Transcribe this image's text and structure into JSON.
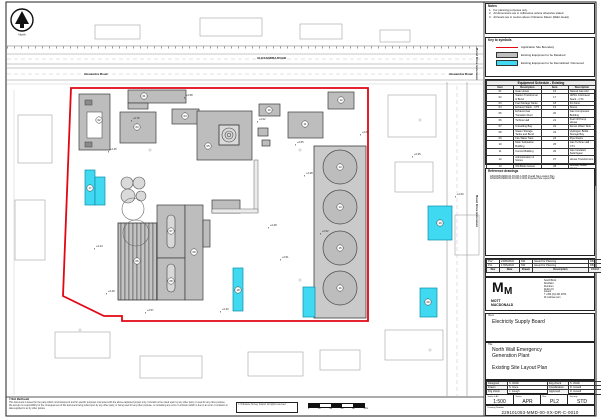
{
  "sheet": {
    "north_label": "North",
    "scalebar_ticks": [
      "0",
      "10",
      "20",
      "30",
      "40",
      "50m"
    ]
  },
  "notes": {
    "title": "Notes",
    "items": [
      "For planning purposes only.",
      "All dimensions are in millimetres unless otherwise stated.",
      "All levels are in metres above Ordnance Datum (Malin Head)."
    ]
  },
  "key": {
    "title": "Key to symbols",
    "items": [
      {
        "swatch": "red-line",
        "label": "Application Site Boundary"
      },
      {
        "swatch": "grey-fill",
        "label": "Existing Equipment to be Retained"
      },
      {
        "swatch": "cyan-fill",
        "label": "Existing Equipment to be Demolished / Removed"
      }
    ]
  },
  "equipment_schedule": {
    "title": "Equipment Schedule - Existing",
    "columns": [
      "Item",
      "Description",
      "Item",
      "Description"
    ],
    "rows": [
      [
        "01",
        "Gate House",
        "16",
        "Natural Gas AGI"
      ],
      [
        "02",
        "Station Transformer & Bund",
        "17",
        "HRSG & Exhaust Stack - CT4"
      ],
      [
        "03",
        "Fuel Storage Tanks",
        "18",
        "Fin Fans"
      ],
      [
        "04",
        "Exhaust Stack - CT5",
        "19",
        "Stores"
      ],
      [
        "05",
        "Exhaust Gas Transition Duct",
        "20",
        "Gas Compressor Building"
      ],
      [
        "06",
        "Turbine Hall",
        "21",
        "Fuel Oil Pump House"
      ],
      [
        "07",
        "Unloading Bay",
        "22",
        "Demin Water Tank"
      ],
      [
        "08",
        "Steam Storage Tanks and Bund",
        "23",
        "Hydrogen Bottle Storage Bay"
      ],
      [
        "09",
        "Fire Water Tank",
        "24",
        "Pipe Racks"
      ],
      [
        "10",
        "Main Substation Building",
        "25",
        "Gas Turbine Hall - CT4"
      ],
      [
        "11",
        "Control Building",
        "26",
        "Gas Insulated Switchgear"
      ],
      [
        "12",
        "Administration & Stores",
        "27",
        "House Transformers"
      ],
      [
        "13",
        "Old Boiler House",
        "28",
        "Auxiliary Boiler House"
      ],
      [
        "14",
        "Water & Diesel Storage Tanks",
        "29",
        "CW Pump House"
      ],
      [
        "15",
        "Water Treatment Building",
        "30",
        "220kV Substation"
      ]
    ]
  },
  "reference_drawings": {
    "title": "Reference drawings",
    "items": [
      {
        "number": "229101053-MMD-00-XX-DR-C-0005",
        "title": "Overall Site Location Plan"
      },
      {
        "number": "229101053-MMD-00-XX-DR-C-0011",
        "title": "Proposed Site Layout Plan"
      }
    ]
  },
  "revisions": {
    "header": [
      "Rev",
      "Date",
      "Drawn",
      "Description",
      "Ch'k'd",
      "App'd"
    ],
    "rows": [
      [
        "PL2",
        "24/06/2022",
        "SW",
        "Issued for Planning",
        "RB",
        "DH"
      ],
      [
        "PL1",
        "17/06/2022",
        "SW",
        "Issued for Planning",
        "RB",
        "DH"
      ]
    ]
  },
  "firm": {
    "logo_letter": "M",
    "name_line1": "MOTT",
    "name_line2": "MACDONALD",
    "address_lines": [
      "South Block",
      "Rockfield",
      "Dundrum",
      "Dublin 16",
      "Ireland",
      "T +353 (0)1 291 9700",
      "W mottmac.com"
    ]
  },
  "client": {
    "label": "Client",
    "name": "Electricity Supply Board"
  },
  "title_block": {
    "label": "Title",
    "line1": "North Wall Emergency",
    "line2": "Generation Plant",
    "subtitle": "Existing Site Layout Plan"
  },
  "credits": {
    "rows": [
      [
        "Designed",
        "S. Webb",
        "Eng check",
        "S. Webb"
      ],
      [
        "Drawn",
        "S. Hone",
        "Coordination",
        "D. Howell"
      ],
      [
        "Drg check",
        "J. Gough",
        "Approved",
        "D. Howell"
      ]
    ]
  },
  "issue": {
    "scale_label": "Scale at A1",
    "scale": "1:500",
    "status_label": "Status",
    "status": "APR",
    "rev_label": "Rev",
    "rev": "PL2",
    "security_label": "Security",
    "security": "STD",
    "drawing_number_label": "Drawing Number",
    "drawing_number": "229101053-MMD-00-XX-DR-C-0010"
  },
  "footer": {
    "copyright": "© Mott MacDonald",
    "disclaimer_lines": [
      "This document is issued for the party which commissioned it and for specific purposes connected with the above-captioned project only. It should not be relied upon by any other party or used for any other purpose.",
      "We accept no responsibility for the consequences of this document being relied upon by any other party, or being used for any other purpose, or containing any error or omission which is due to an error or omission in data supplied to us by other parties."
    ],
    "os_credit": "© Ordnance Survey Ireland. All rights reserved."
  },
  "plan": {
    "colors": {
      "boundary": "#e30613",
      "retained_fill": "#bdbdbd",
      "retained_stroke": "#3c3c3c",
      "demolish_fill": "#3fd9f2",
      "demolish_stroke": "#0a8fa6",
      "context_stroke": "#a2a2a2",
      "road_stroke": "#8f8f8f"
    },
    "road_labels": [
      {
        "x": 84,
        "y": 75,
        "text": "Alexandra Road",
        "rot": 0
      },
      {
        "x": 449,
        "y": 75,
        "text": "Alexandra Road",
        "rot": 0
      },
      {
        "x": 257,
        "y": 59,
        "text": "ALEXANDRA ROAD",
        "rot": 0
      },
      {
        "x": 476,
        "y": 48,
        "text": "Bond Drive Extension",
        "rot": 90
      },
      {
        "x": 476,
        "y": 195,
        "text": "Bond Drive Extension",
        "rot": 90
      }
    ],
    "boundary_points": "71,88 368,88 368,321 122,321 122,316 104,316 63,296",
    "retained": [
      {
        "x": 128,
        "y": 90,
        "w": 58,
        "h": 13
      },
      {
        "x": 128,
        "y": 103,
        "w": 20,
        "h": 6
      },
      {
        "x": 79,
        "y": 94,
        "w": 31,
        "h": 56
      },
      {
        "x": 120,
        "y": 112,
        "w": 36,
        "h": 31
      },
      {
        "x": 172,
        "y": 109,
        "w": 27,
        "h": 15
      },
      {
        "x": 197,
        "y": 111,
        "w": 55,
        "h": 49
      },
      {
        "x": 259,
        "y": 104,
        "w": 21,
        "h": 12
      },
      {
        "x": 288,
        "y": 112,
        "w": 35,
        "h": 26
      },
      {
        "x": 328,
        "y": 92,
        "w": 26,
        "h": 17
      },
      {
        "x": 157,
        "y": 205,
        "w": 28,
        "h": 53
      },
      {
        "x": 157,
        "y": 258,
        "w": 28,
        "h": 42
      },
      {
        "x": 185,
        "y": 205,
        "w": 18,
        "h": 95
      },
      {
        "x": 212,
        "y": 200,
        "w": 28,
        "h": 13
      },
      {
        "x": 203,
        "y": 220,
        "w": 7,
        "h": 27
      },
      {
        "x": 258,
        "y": 128,
        "w": 10,
        "h": 8
      },
      {
        "x": 262,
        "y": 140,
        "w": 8,
        "h": 6
      }
    ],
    "hatched_hall": {
      "x": 118,
      "y": 223,
      "w": 39,
      "h": 77
    },
    "ovals": [
      {
        "x": 167,
        "y": 215,
        "w": 8,
        "h": 33
      },
      {
        "x": 167,
        "y": 264,
        "w": 8,
        "h": 28
      }
    ],
    "tank_farm": {
      "bund": {
        "x": 314,
        "y": 146,
        "w": 52,
        "h": 172
      },
      "circles": [
        {
          "cx": 340,
          "cy": 167,
          "r": 17
        },
        {
          "cx": 340,
          "cy": 207,
          "r": 17
        },
        {
          "cx": 340,
          "cy": 248,
          "r": 17
        },
        {
          "cx": 340,
          "cy": 288,
          "r": 17
        }
      ]
    },
    "small_tanks": [
      {
        "cx": 127,
        "cy": 183,
        "r": 6
      },
      {
        "cx": 139,
        "cy": 183,
        "r": 6
      },
      {
        "cx": 128,
        "cy": 196,
        "r": 7
      },
      {
        "cx": 141,
        "cy": 196,
        "r": 5
      }
    ],
    "outline_circles": [
      {
        "cx": 133,
        "cy": 209,
        "r": 11
      },
      {
        "cx": 136,
        "cy": 233,
        "r": 13
      }
    ],
    "demolished": [
      {
        "x": 85,
        "y": 170,
        "w": 10,
        "h": 35
      },
      {
        "x": 95,
        "y": 177,
        "w": 10,
        "h": 28
      },
      {
        "x": 233,
        "y": 268,
        "w": 10,
        "h": 43
      },
      {
        "x": 303,
        "y": 287,
        "w": 12,
        "h": 30
      },
      {
        "x": 428,
        "y": 206,
        "w": 24,
        "h": 34
      },
      {
        "x": 420,
        "y": 288,
        "w": 17,
        "h": 29
      }
    ],
    "context": [
      {
        "x": 95,
        "y": 25,
        "w": 45,
        "h": 14
      },
      {
        "x": 200,
        "y": 18,
        "w": 62,
        "h": 18
      },
      {
        "x": 300,
        "y": 24,
        "w": 42,
        "h": 15
      },
      {
        "x": 380,
        "y": 30,
        "w": 30,
        "h": 12
      },
      {
        "x": 388,
        "y": 95,
        "w": 48,
        "h": 42
      },
      {
        "x": 395,
        "y": 162,
        "w": 38,
        "h": 30
      },
      {
        "x": 455,
        "y": 215,
        "w": 24,
        "h": 40
      },
      {
        "x": 18,
        "y": 115,
        "w": 34,
        "h": 48
      },
      {
        "x": 15,
        "y": 200,
        "w": 30,
        "h": 60
      },
      {
        "x": 55,
        "y": 332,
        "w": 55,
        "h": 26
      },
      {
        "x": 140,
        "y": 356,
        "w": 62,
        "h": 22
      },
      {
        "x": 248,
        "y": 352,
        "w": 55,
        "h": 24
      },
      {
        "x": 320,
        "y": 350,
        "w": 40,
        "h": 20
      },
      {
        "x": 385,
        "y": 330,
        "w": 58,
        "h": 30
      }
    ],
    "item_labels": [
      {
        "x": 144,
        "y": 96,
        "n": "01"
      },
      {
        "x": 99,
        "y": 120,
        "n": "02"
      },
      {
        "x": 137,
        "y": 127,
        "n": "03"
      },
      {
        "x": 185,
        "y": 116,
        "n": "04"
      },
      {
        "x": 208,
        "y": 146,
        "n": "05"
      },
      {
        "x": 137,
        "y": 261,
        "n": "06"
      },
      {
        "x": 171,
        "y": 231,
        "n": "07"
      },
      {
        "x": 171,
        "y": 281,
        "n": "08"
      },
      {
        "x": 194,
        "y": 252,
        "n": "09"
      },
      {
        "x": 269,
        "y": 110,
        "n": "10"
      },
      {
        "x": 305,
        "y": 124,
        "n": "11"
      },
      {
        "x": 341,
        "y": 100,
        "n": "12"
      },
      {
        "x": 340,
        "y": 167,
        "n": "13"
      },
      {
        "x": 340,
        "y": 207,
        "n": "14"
      },
      {
        "x": 340,
        "y": 248,
        "n": "15"
      },
      {
        "x": 340,
        "y": 288,
        "n": "16"
      },
      {
        "x": 90,
        "y": 188,
        "n": "17"
      },
      {
        "x": 238,
        "y": 290,
        "n": "18"
      },
      {
        "x": 440,
        "y": 223,
        "n": "19"
      },
      {
        "x": 428,
        "y": 302,
        "n": "20"
      }
    ],
    "spot_levels": [
      {
        "x": 133,
        "y": 119,
        "v": "+2.76"
      },
      {
        "x": 110,
        "y": 150,
        "v": "+2.45"
      },
      {
        "x": 186,
        "y": 96,
        "v": "+2.58"
      },
      {
        "x": 259,
        "y": 120,
        "v": "+2.62"
      },
      {
        "x": 297,
        "y": 143,
        "v": "+2.55"
      },
      {
        "x": 306,
        "y": 174,
        "v": "+2.38"
      },
      {
        "x": 322,
        "y": 232,
        "v": "+2.52"
      },
      {
        "x": 96,
        "y": 247,
        "v": "+2.44"
      },
      {
        "x": 108,
        "y": 292,
        "v": "+2.49"
      },
      {
        "x": 147,
        "y": 311,
        "v": "+2.57"
      },
      {
        "x": 222,
        "y": 310,
        "v": "+2.40"
      },
      {
        "x": 362,
        "y": 133,
        "v": "+2.63"
      },
      {
        "x": 414,
        "y": 155,
        "v": "+2.35"
      },
      {
        "x": 457,
        "y": 195,
        "v": "+2.60"
      },
      {
        "x": 270,
        "y": 226,
        "v": "+2.48"
      },
      {
        "x": 282,
        "y": 258,
        "v": "+2.51"
      }
    ],
    "crosses": [
      {
        "x": 150,
        "y": 150
      },
      {
        "x": 300,
        "y": 150
      },
      {
        "x": 150,
        "y": 280
      },
      {
        "x": 300,
        "y": 280
      },
      {
        "x": 420,
        "y": 120
      },
      {
        "x": 80,
        "y": 330
      },
      {
        "x": 430,
        "y": 350
      }
    ]
  }
}
